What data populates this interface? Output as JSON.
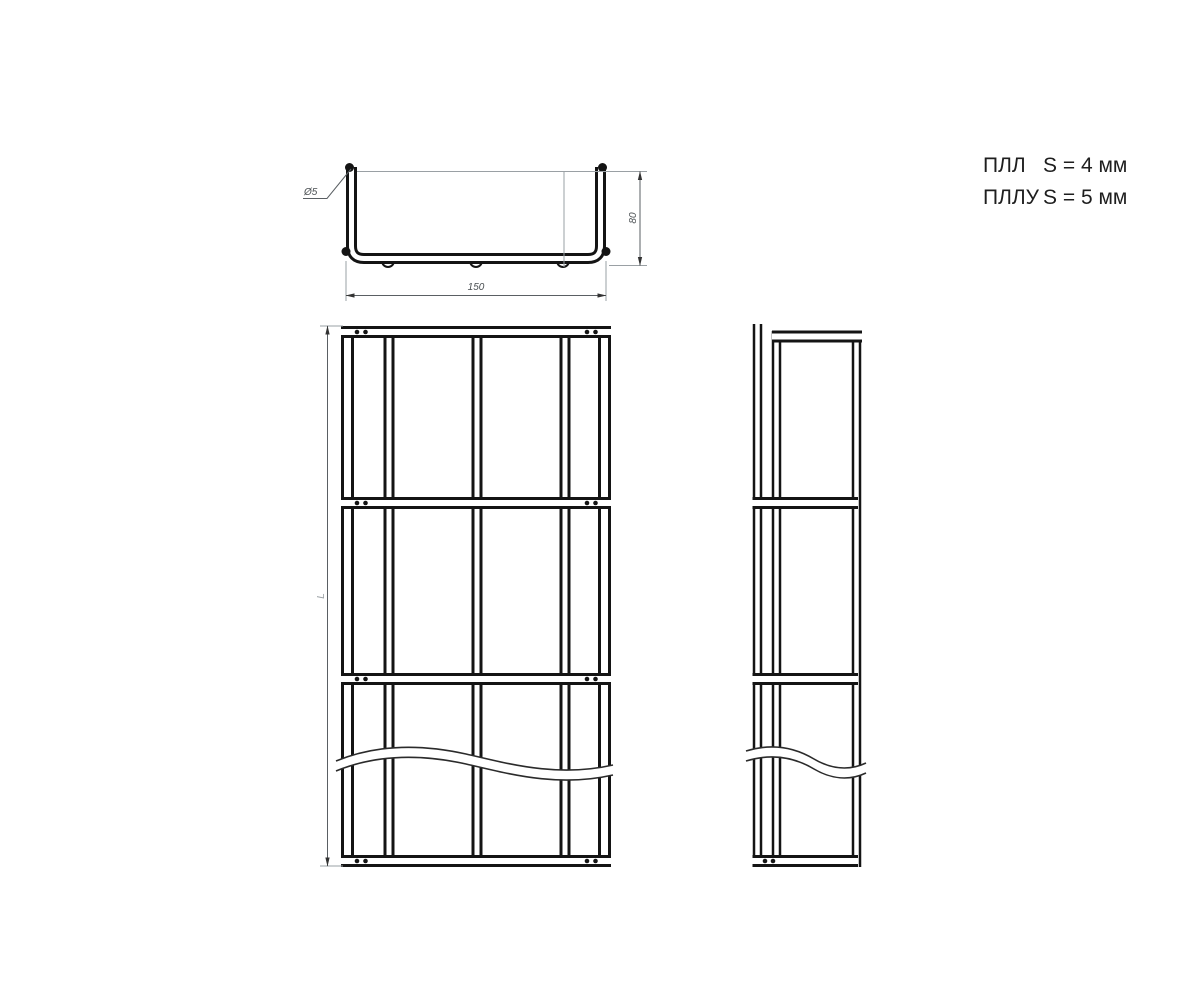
{
  "spec_note": {
    "rows": [
      {
        "model": "ПЛЛ",
        "value": "S = 4 мм"
      },
      {
        "model": "ПЛЛУ",
        "value": "S = 5 мм"
      }
    ]
  },
  "cross_section_view": {
    "width_label": "150",
    "height_label": "80",
    "wire_diameter_label": "Ø5"
  },
  "plan_view": {
    "length_label": "L"
  },
  "colors": {
    "line": "#141414",
    "thin_line": "#9aa0a4",
    "dimension": "#5a5f63",
    "text": "#1e1e1e",
    "background": "#ffffff"
  }
}
